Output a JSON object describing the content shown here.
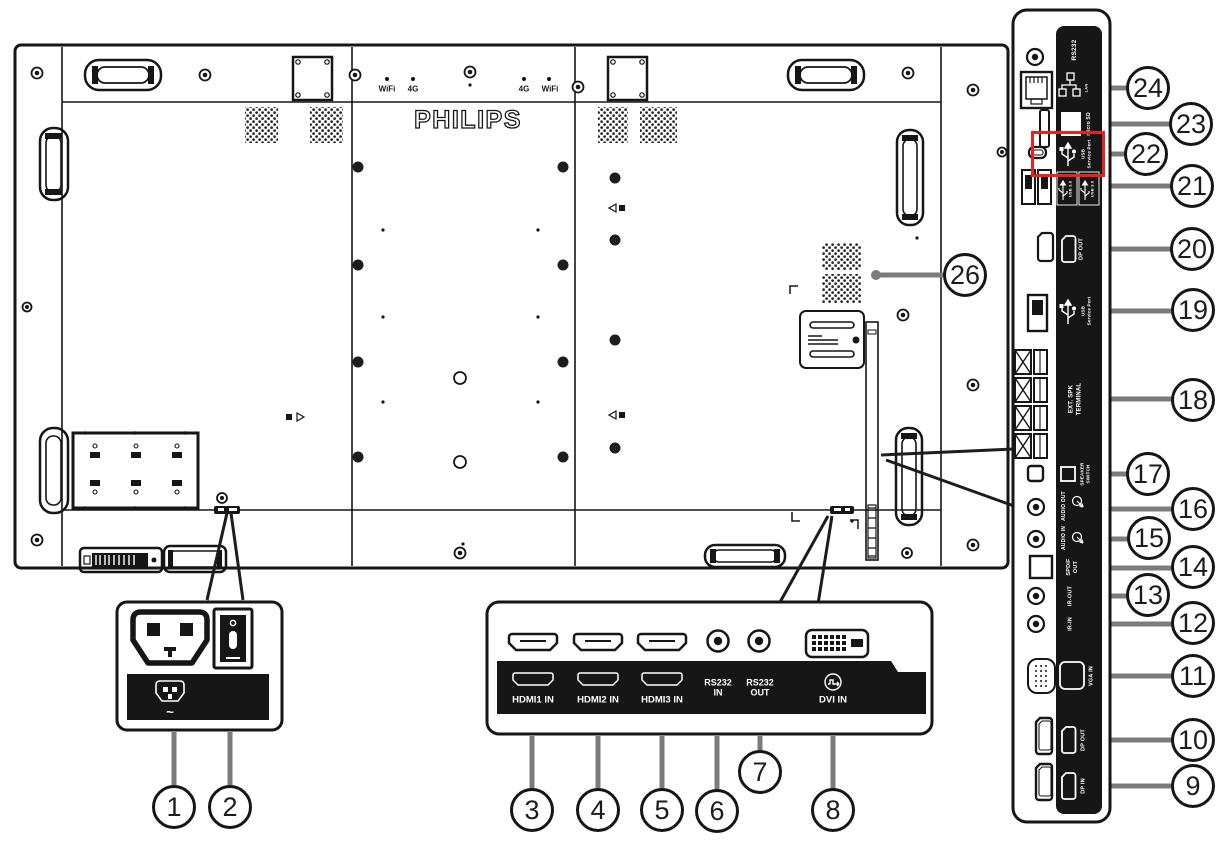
{
  "brand_logo": "PHILIPS",
  "panel_markings": {
    "wifi_left": "WiFi",
    "g4_left": "4G",
    "g4_right": "4G",
    "wifi_right": "WiFi"
  },
  "power_box": {
    "ac_symbol": "~"
  },
  "bottom_ports": {
    "hdmi1": "HDMI1 IN",
    "hdmi2": "HDMI2 IN",
    "hdmi3": "HDMI3 IN",
    "rs232_in": "RS232\nIN",
    "rs232_out": "RS232\nOUT",
    "dvi": "DVI IN"
  },
  "side_ports": {
    "rs232": "RS232",
    "lan": "LAN",
    "micro_sd": "micro SD",
    "usb_service_1": "USB\nService Port",
    "usb30_1": "USB 3.0",
    "usb30_2": "USB 3.0",
    "dp_out_1": "DP OUT",
    "usb_service_2": "USB\nService Port",
    "ext_spk": "EXT. SPK\nTERMINAL",
    "speaker_switch": "SPEAKER\nSWITCH",
    "audio_out": "AUDIO OUT",
    "audio_in": "AUDIO IN",
    "spdif_out": "SPDIF\nOUT",
    "ir_out": "IR-OUT",
    "ir_in": "IR-IN",
    "vga_in": "VGA IN",
    "dp_out_2": "DP OUT",
    "dp_in": "DP IN"
  },
  "callouts": {
    "c1": "1",
    "c2": "2",
    "c3": "3",
    "c4": "4",
    "c5": "5",
    "c6": "6",
    "c7": "7",
    "c8": "8",
    "c9": "9",
    "c10": "10",
    "c11": "11",
    "c12": "12",
    "c13": "13",
    "c14": "14",
    "c15": "15",
    "c16": "16",
    "c17": "17",
    "c18": "18",
    "c19": "19",
    "c20": "20",
    "c21": "21",
    "c22": "22",
    "c23": "23",
    "c24": "24",
    "c26": "26"
  },
  "colors": {
    "highlight_red": "#e8231f",
    "leader_gray": "#7b7b7b",
    "line_black": "#161616"
  }
}
